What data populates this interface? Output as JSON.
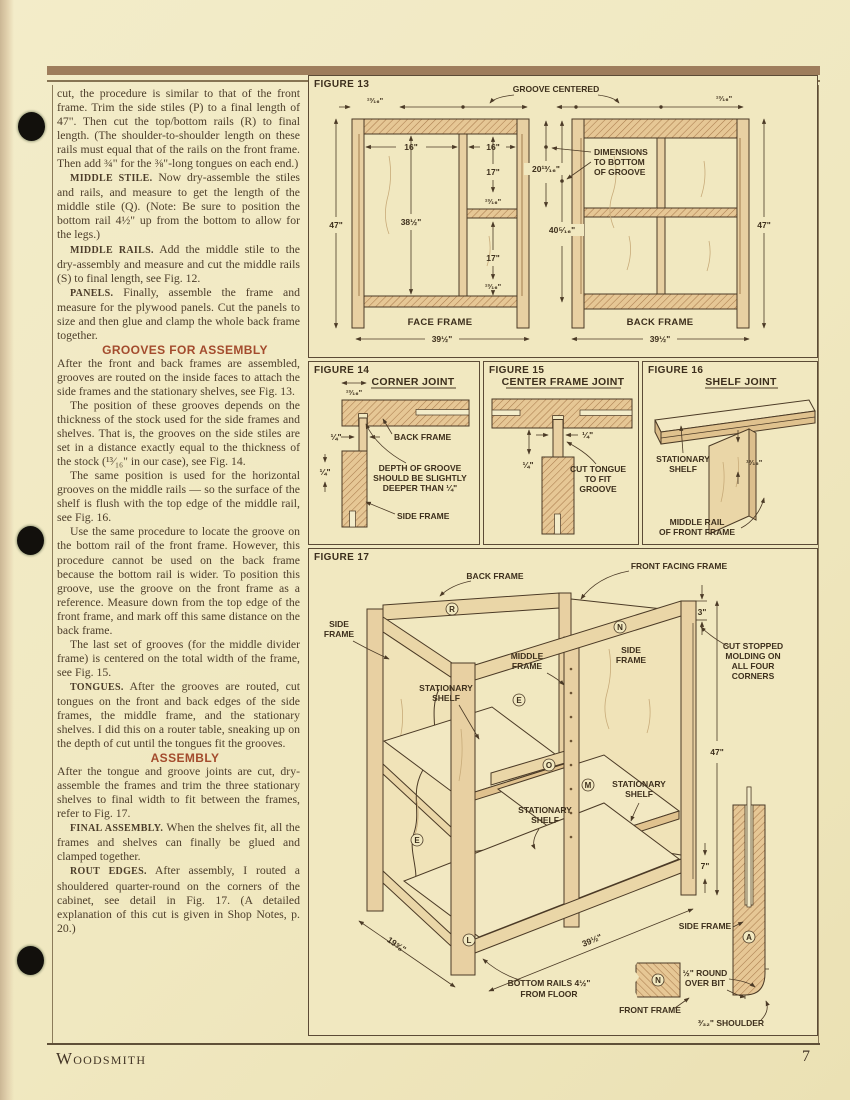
{
  "page": {
    "footer_brand": "Woodsmith",
    "footer_page": "7"
  },
  "column": {
    "p1": {
      "text": "cut, the procedure is similar to that of the front frame. Trim the side stiles (P) to a final length of 47\". Then cut the top/bottom rails (R) to final length. (The shoulder-to-shoulder length on these rails must equal that of the rails on the front frame. Then add ¾\" for the ⅜\"-long tongues on each end.)"
    },
    "p2": {
      "lead": "MIDDLE STILE.",
      "text": " Now dry-assemble the stiles and rails, and measure to get the length of the middle stile (Q). (Note: Be sure to position the bottom rail 4½\" up from the bottom to allow for the legs.)"
    },
    "p3": {
      "lead": "MIDDLE RAILS.",
      "text": " Add the middle stile to the dry-assembly and measure and cut the middle rails (S) to final length, see Fig. 12."
    },
    "p4": {
      "lead": "PANELS.",
      "text": " Finally, assemble the frame and measure for the plywood panels. Cut the panels to size and then glue and clamp the whole back frame together."
    },
    "h1": "GROOVES FOR ASSEMBLY",
    "p5": {
      "text": "After the front and back frames are assembled, grooves are routed on the inside faces to attach the side frames and the stationary shelves, see Fig. 13."
    },
    "p6": {
      "text": "The position of these grooves depends on the thickness of the stock used for the side frames and shelves. That is, the grooves on the side stiles are set in a distance exactly equal to the thickness of the stock (¹³⁄₁₆\" in our case), see Fig. 14."
    },
    "p7": {
      "text": "The same position is used for the horizontal grooves on the middle rails — so the surface of the shelf is flush with the top edge of the middle rail, see Fig. 16."
    },
    "p8": {
      "text": "Use the same procedure to locate the groove on the bottom rail of the front frame. However, this procedure cannot be used on the back frame because the bottom rail is wider. To position this groove, use the groove on the front frame as a reference. Measure down from the top edge of the front frame, and mark off this same distance on the back frame."
    },
    "p9": {
      "text": "The last set of grooves (for the middle divider frame) is centered on the total width of the frame, see Fig. 15."
    },
    "p10": {
      "lead": "TONGUES.",
      "text": " After the grooves are routed, cut tongues on the front and back edges of the side frames, the middle frame, and the stationary shelves. I did this on a router table, sneaking up on the depth of cut until the tongues fit the grooves."
    },
    "h2": "ASSEMBLY",
    "p11": {
      "text": "After the tongue and groove joints are cut, dry-assemble the frames and trim the three stationary shelves to final width to fit between the frames, refer to Fig. 17."
    },
    "p12": {
      "lead": "FINAL ASSEMBLY.",
      "text": " When the shelves fit, all the frames and shelves can finally be glued and clamped together."
    },
    "p13": {
      "lead": "ROUT EDGES.",
      "text": " After assembly, I routed a shouldered quarter-round on the corners of the cabinet, see detail in Fig. 17. (A detailed explanation of this cut is given in Shop Notes, p. 20.)"
    }
  },
  "figures": {
    "fig13": {
      "tag": "FIGURE 13",
      "groove_centered": "GROOVE CENTERED",
      "note": [
        "DIMENSIONS",
        "TO BOTTOM",
        "OF GROOVE"
      ],
      "face_label": "FACE FRAME",
      "back_label": "BACK FRAME",
      "d1316a": "¹³⁄₁₆\"",
      "d16a": "16\"",
      "d16b": "16\"",
      "d17a": "17\"",
      "d1316b": "¹³⁄₁₆\"",
      "d17b": "17\"",
      "d1316c": "¹³⁄₁₆\"",
      "d38": "38½\"",
      "d47a": "47\"",
      "d39a": "39½\"",
      "d20": "20¹³⁄₁₆\"",
      "d40": "40⁵⁄₁₆\"",
      "d1316d": "¹³⁄₁₆\"",
      "d47b": "47\"",
      "d39b": "39½\""
    },
    "fig14": {
      "tag": "FIGURE 14",
      "title": "CORNER JOINT",
      "d1316": "¹³⁄₁₆\"",
      "dq1": "¼\"",
      "dq2": "¼\"",
      "back_frame": "BACK FRAME",
      "note": [
        "DEPTH OF GROOVE",
        "SHOULD BE SLIGHTLY",
        "DEEPER THAN ¼\""
      ],
      "side_frame": "SIDE FRAME"
    },
    "fig15": {
      "tag": "FIGURE 15",
      "title": "CENTER FRAME JOINT",
      "dq1": "¼\"",
      "dq2": "¼\"",
      "note": [
        "CUT TONGUE",
        "TO FIT",
        "GROOVE"
      ]
    },
    "fig16": {
      "tag": "FIGURE 16",
      "title": "SHELF JOINT",
      "shelf": [
        "STATIONARY",
        "SHELF"
      ],
      "d1316": "¹³⁄₁₆\"",
      "rail": [
        "MIDDLE RAIL",
        "OF FRONT FRAME"
      ]
    },
    "fig17": {
      "tag": "FIGURE 17",
      "back_frame": "BACK FRAME",
      "front_facing": "FRONT FACING FRAME",
      "side_frame_l": [
        "SIDE",
        "FRAME"
      ],
      "side_frame_r": [
        "SIDE",
        "FRAME"
      ],
      "middle_frame": [
        "MIDDLE",
        "FRAME"
      ],
      "shelf1": [
        "STATIONARY",
        "SHELF"
      ],
      "shelf2": [
        "STATIONARY",
        "SHELF"
      ],
      "shelf3": [
        "STATIONARY",
        "SHELF"
      ],
      "d3": "3\"",
      "d47": "47\"",
      "d7": "7\"",
      "d19": "19⅝\"",
      "d39": "39½\"",
      "molding": [
        "CUT STOPPED",
        "MOLDING ON",
        "ALL FOUR",
        "CORNERS"
      ],
      "bottom_rails": [
        "BOTTOM RAILS 4½\"",
        "FROM FLOOR"
      ],
      "detail_side": "SIDE FRAME",
      "round_over": [
        "½\" ROUND",
        "OVER BIT"
      ],
      "front_frame": "FRONT FRAME",
      "shoulder": "³⁄₃₂\" SHOULDER",
      "letters": {
        "r": "R",
        "n": "N",
        "e1": "E",
        "o": "O",
        "m": "M",
        "e2": "E",
        "l": "L",
        "n2": "N",
        "a": "A"
      }
    }
  }
}
